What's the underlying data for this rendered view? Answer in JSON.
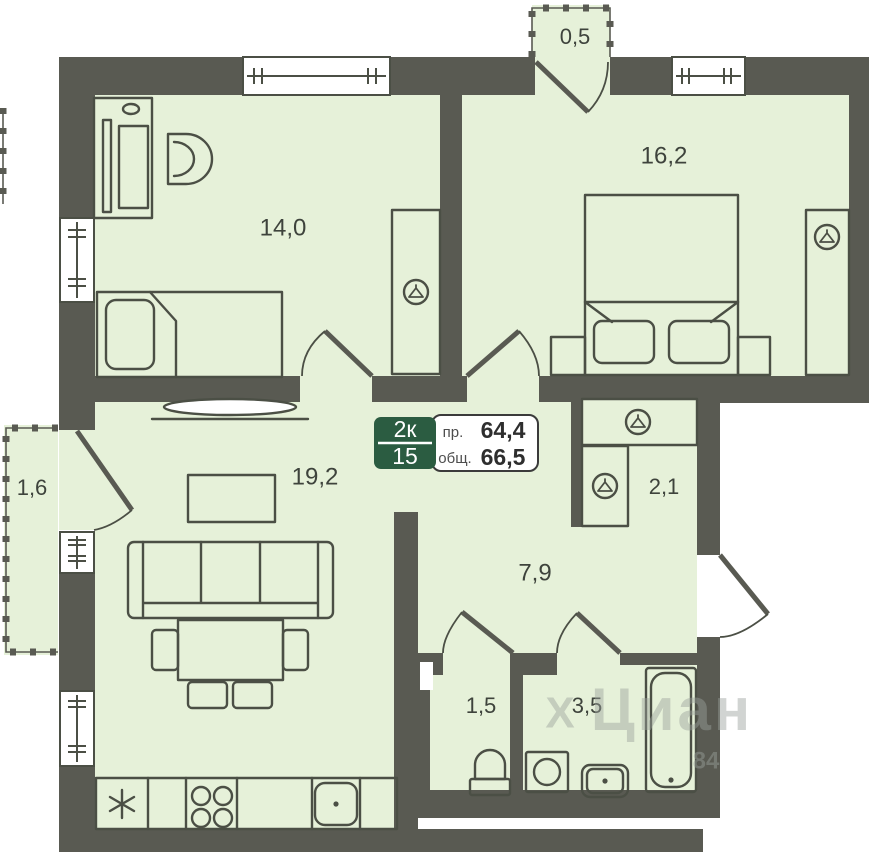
{
  "plan": {
    "badge": {
      "rooms": "2к",
      "floor": "15",
      "label_projected": "пр.",
      "value_projected": "64,4",
      "label_total": "общ.",
      "value_total": "66,5"
    },
    "rooms": {
      "bedroom_left": "14,0",
      "bedroom_right": "16,2",
      "balcony_top": "0,5",
      "balcony_left": "1,6",
      "living_room": "19,2",
      "closet": "2,1",
      "hallway": "7,9",
      "toilet": "1,5",
      "bathroom": "3,5"
    },
    "watermark": {
      "logo": "Х",
      "text": "Циан",
      "digits": "84"
    },
    "icons": {
      "wardrobe": "hanger",
      "fridge": "snowflake-asterisk"
    },
    "colors": {
      "wall": "#595a52",
      "floor": "#e6f1d9",
      "outline": "#4b4f45",
      "badge_green": "#2b5c41",
      "text": "#3e433c",
      "watermark": "#9ba29c"
    }
  }
}
